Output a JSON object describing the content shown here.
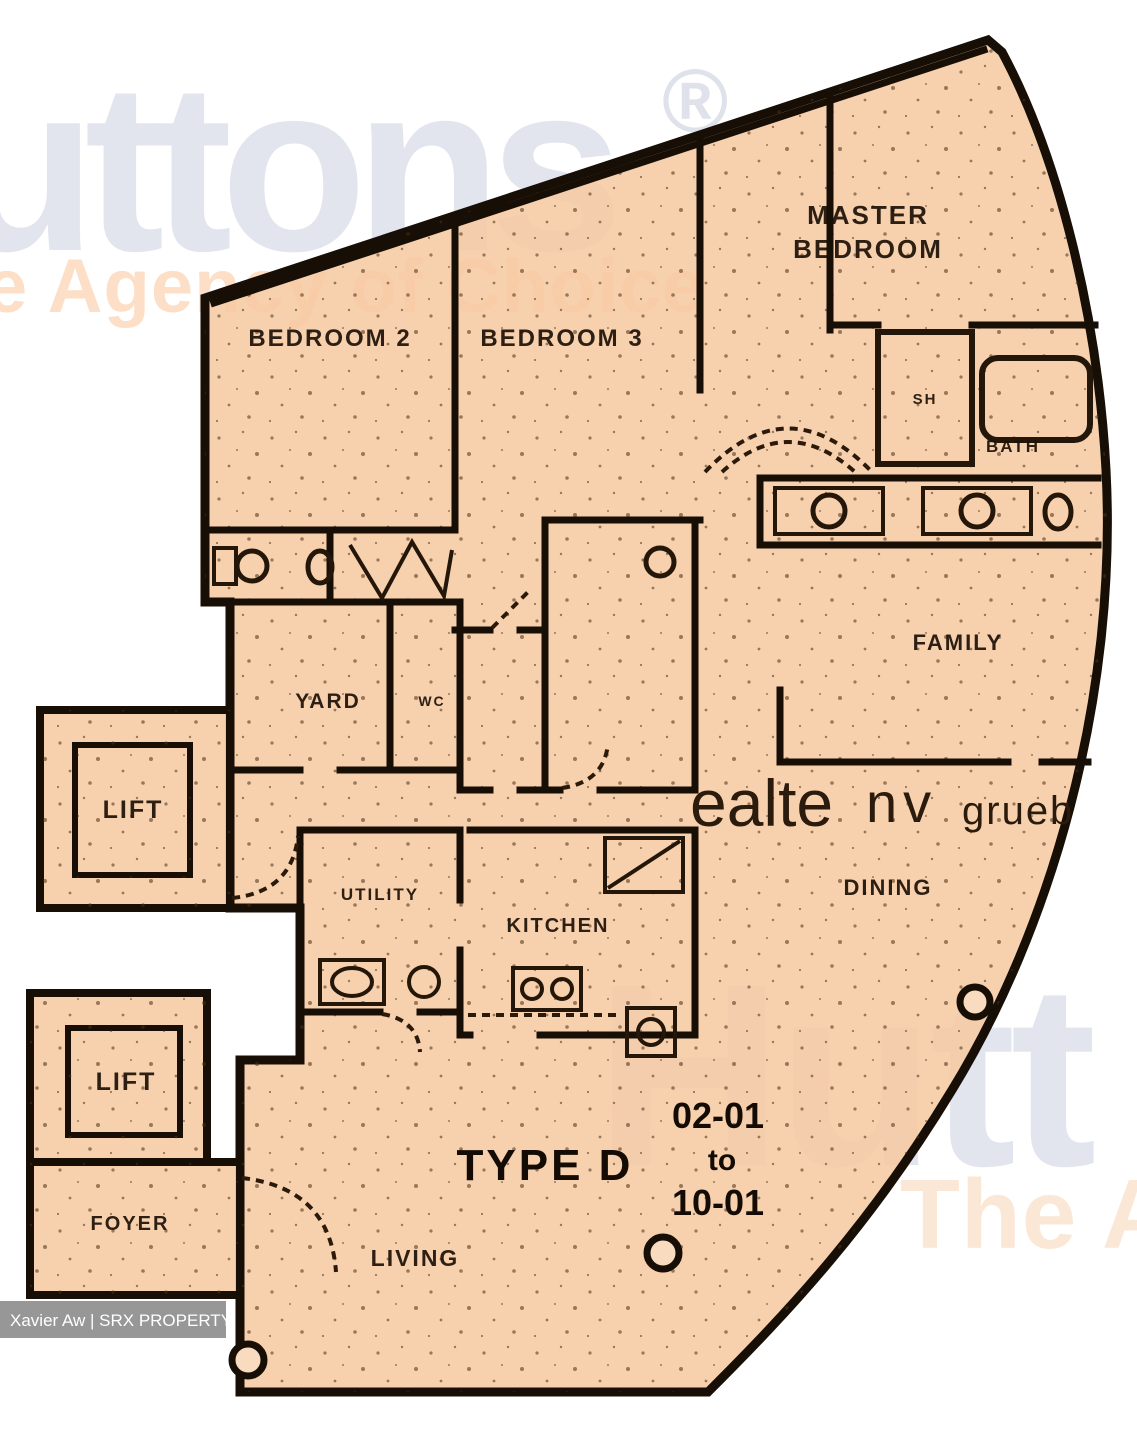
{
  "watermarks": {
    "brand_top": "uttons",
    "registered_mark": "®",
    "tagline_top": "e Agency of Choice",
    "brand_bottom": "Hutt",
    "tagline_bottom": "The Ag",
    "scan_artifact": {
      "part1": "ealte",
      "part2": "nv",
      "part3": "grueb"
    }
  },
  "plan": {
    "type_label": "TYPE D",
    "unit_range": {
      "from": "02-01",
      "connector": "to",
      "to": "10-01"
    },
    "rooms": {
      "master_bedroom_line1": "MASTER",
      "master_bedroom_line2": "BEDROOM",
      "bedroom2": "BEDROOM 2",
      "bedroom3": "BEDROOM 3",
      "shower": "SH",
      "bath": "BATH",
      "family": "FAMILY",
      "yard": "YARD",
      "wc": "WC",
      "dining": "DINING",
      "utility": "UTILITY",
      "kitchen": "KITCHEN",
      "living": "LIVING",
      "foyer": "FOYER"
    },
    "lifts": {
      "upper": "LIFT",
      "lower": "LIFT"
    }
  },
  "credit": {
    "text": "Xavier Aw | SRX PROPERTY"
  },
  "colors": {
    "plan_fill": "#f6c9a2",
    "wall": "#170e06",
    "label": "#1c1106",
    "watermark_gray": "#e2e5ee",
    "watermark_orange": "#fcdfc6",
    "watermark_orange_bottom": "#fbe7d5",
    "credit_bg": "rgba(125,125,125,0.8)",
    "credit_text": "#ffffff"
  }
}
